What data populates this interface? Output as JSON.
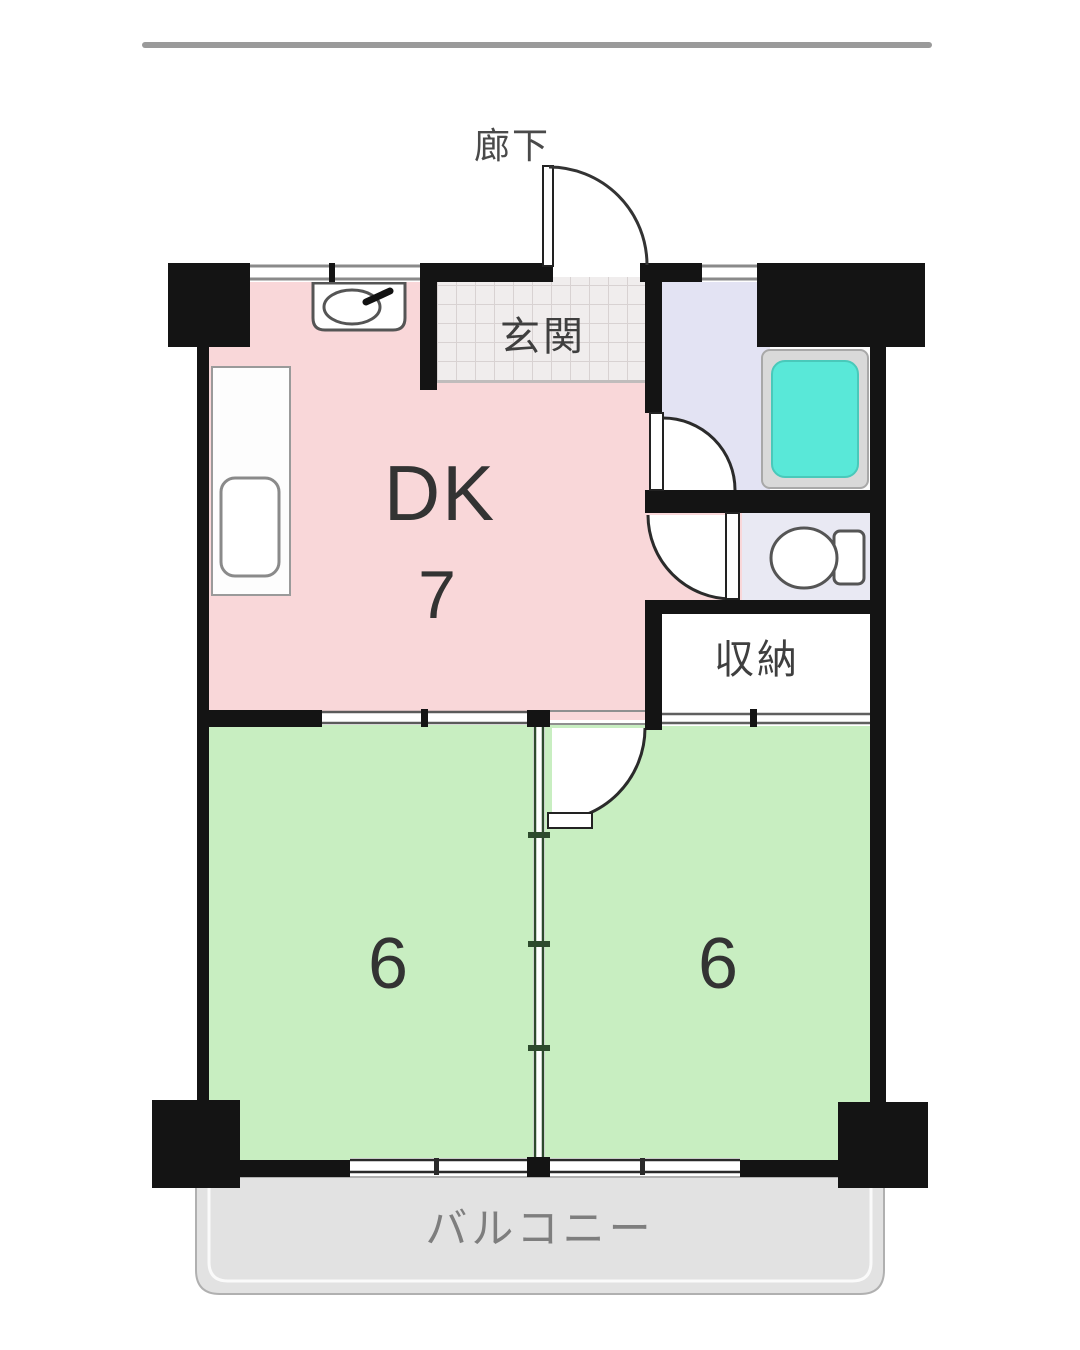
{
  "plan": {
    "labels": {
      "corridor": "廊下",
      "entrance": "玄関",
      "dk": "DK",
      "dk_size": "7",
      "storage": "収納",
      "bedroom_left_size": "6",
      "bedroom_right_size": "6",
      "balcony": "バルコニー"
    },
    "colors": {
      "wall": "#141414",
      "dk_floor": "#f9d7d9",
      "bedroom_floor": "#c8eec1",
      "corridor_floor": "#e3e3f3",
      "toilet_floor": "#e9e9f3",
      "storage_floor": "#ffffff",
      "bathroom_floor": "#fdfdfd",
      "bathtub_fill": "#59e8d8",
      "bathtub_frame": "#d9d9d9",
      "balcony_floor": "#e2e2e2",
      "entrance_tile": "#f0eded",
      "partition_line": "#2d4a2d",
      "top_rule": "#9a9a9a"
    },
    "fixtures": [
      {
        "id": "kitchen-sink",
        "label": "kitchen-sink-icon"
      },
      {
        "id": "kitchen-counter",
        "label": "counter-icon"
      },
      {
        "id": "bathtub",
        "label": "bathtub-icon"
      },
      {
        "id": "toilet",
        "label": "toilet-icon"
      }
    ]
  }
}
